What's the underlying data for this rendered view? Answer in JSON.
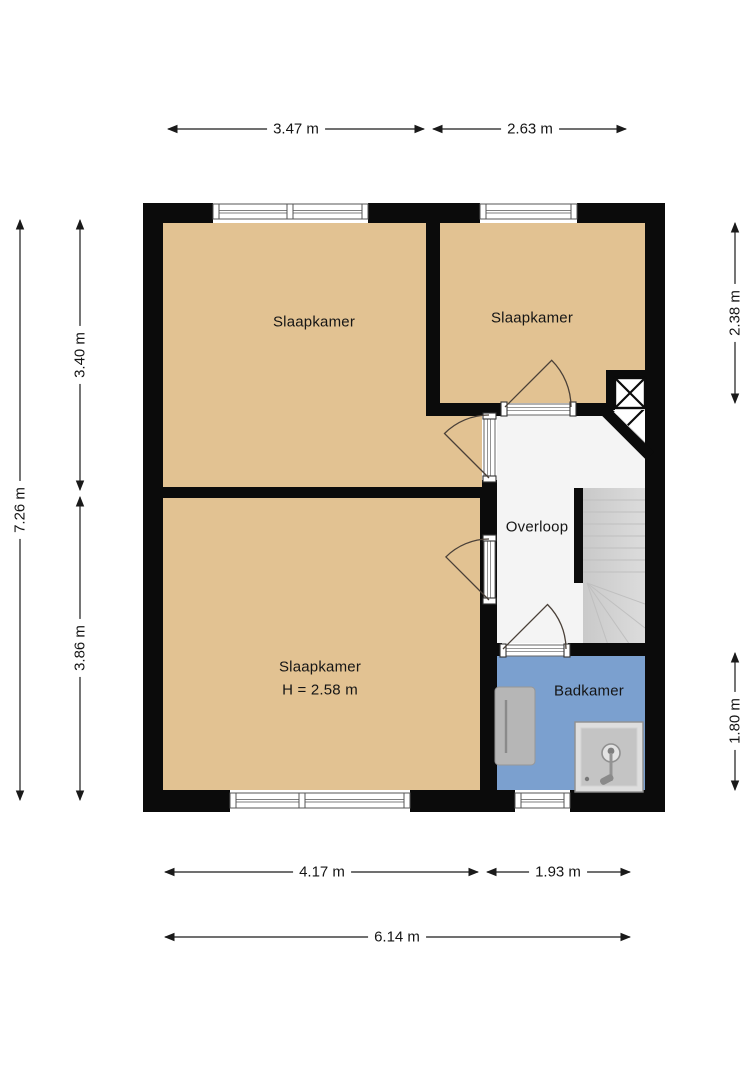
{
  "plan_type": "floor-plan",
  "rooms": [
    {
      "name": "Slaapkamer",
      "position": "top-left"
    },
    {
      "name": "Slaapkamer",
      "position": "top-right"
    },
    {
      "name": "Slaapkamer",
      "position": "bottom-left",
      "ceiling_height": "H = 2.58 m"
    },
    {
      "name": "Overloop",
      "position": "center-right"
    },
    {
      "name": "Badkamer",
      "position": "bottom-right"
    }
  ],
  "dimensions": {
    "top_left": "3.47 m",
    "top_right": "2.63 m",
    "left_total": "7.26 m",
    "left_upper": "3.40 m",
    "left_lower": "3.86 m",
    "right_upper": "2.38 m",
    "right_lower": "1.80 m",
    "bottom_left": "4.17 m",
    "bottom_right": "1.93 m",
    "bottom_total": "6.14 m"
  },
  "symbols": [
    {
      "name": "stairs"
    },
    {
      "name": "shaft"
    },
    {
      "name": "shower"
    },
    {
      "name": "radiator"
    },
    {
      "name": "door-swing"
    },
    {
      "name": "window"
    }
  ],
  "colors": {
    "wall": "#0b0b0b",
    "bedroom_floor": "#e2c292",
    "bathroom_floor": "#7ba0cf",
    "landing_floor": "#f4f4f4",
    "stairs": "#d4d4d4",
    "background": "#ffffff",
    "dimension_line": "#1a1a1a"
  }
}
